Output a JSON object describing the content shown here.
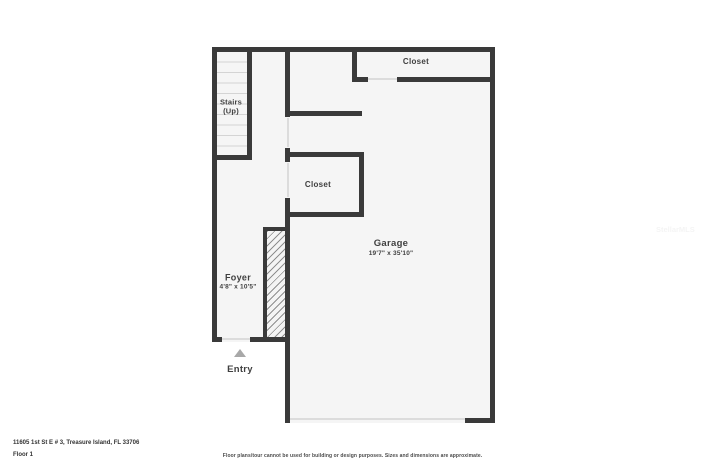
{
  "plan": {
    "labels": {
      "closet_top": "Closet",
      "stairs_line1": "Stairs",
      "stairs_line2": "(Up)",
      "closet_mid": "Closet",
      "garage": "Garage",
      "garage_dims": "19'7\" x 35'10\"",
      "foyer": "Foyer",
      "foyer_dims": "4'8\" x 10'5\"",
      "entry": "Entry"
    },
    "icons": {
      "entry_arrow": "triangle-up"
    }
  },
  "footer": {
    "address": "11605 1st St E # 3, Treasure Island, FL 33706",
    "floor_label": "Floor 1",
    "disclaimer": "Floor plans/tour cannot be used for building or design purposes. Sizes and dimensions are approximate."
  },
  "watermark": "StellarMLS",
  "colors": {
    "wall": "#3a3a3a",
    "floor": "#f5f5f5",
    "stair_tread_line": "#d4d4d4",
    "door_opening_line": "#dcdcdc",
    "hatch_line": "#8f8f8f",
    "entry_arrow": "#a8a8a8",
    "label_text": "#3f3f3f",
    "footer_text": "#333333"
  }
}
